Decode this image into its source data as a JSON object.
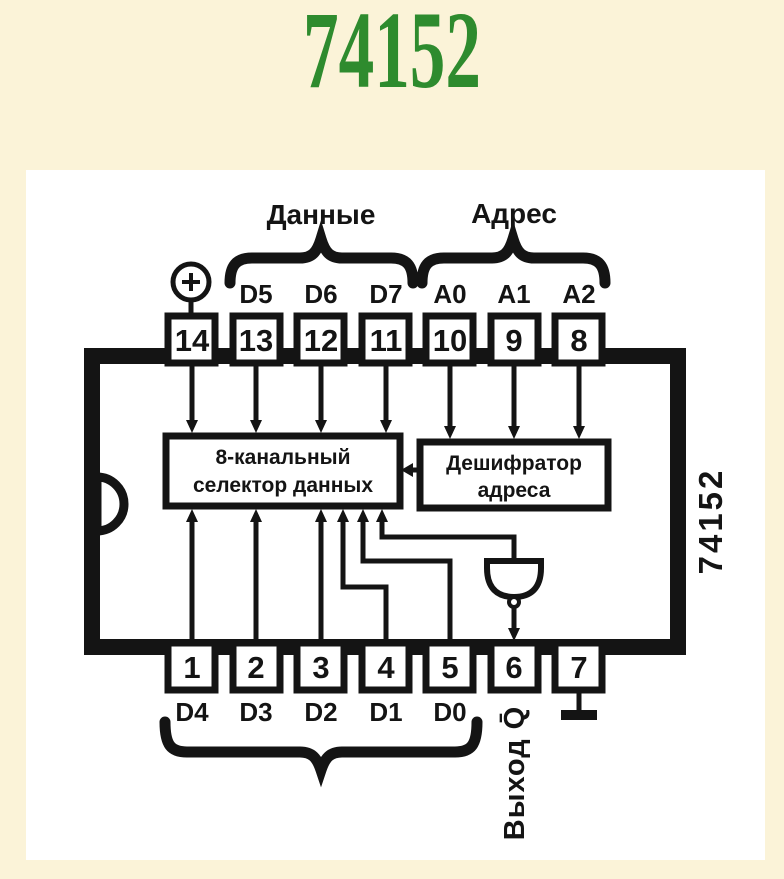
{
  "colors": {
    "background": "#FBF3D8",
    "panel": "#FFFFFF",
    "title_green": "#2E8B2E",
    "ink": "#141414"
  },
  "page": {
    "title": "74152"
  },
  "diagram": {
    "labels": {
      "data_group": "Данные",
      "address_group": "Адрес",
      "inputs_group": "Входы",
      "output": "Выход Q̄",
      "chip_side": "74152"
    },
    "selector_block": {
      "line1": "8-канальный",
      "line2": "селектор данных"
    },
    "decoder_block": {
      "line1": "Дешифратор",
      "line2": "адреса"
    },
    "top_pins": [
      {
        "number": "14",
        "label": ""
      },
      {
        "number": "13",
        "label": "D5"
      },
      {
        "number": "12",
        "label": "D6"
      },
      {
        "number": "11",
        "label": "D7"
      },
      {
        "number": "10",
        "label": "A0"
      },
      {
        "number": "9",
        "label": "A1"
      },
      {
        "number": "8",
        "label": "A2"
      }
    ],
    "bottom_pins": [
      {
        "number": "1",
        "label": "D4"
      },
      {
        "number": "2",
        "label": "D3"
      },
      {
        "number": "3",
        "label": "D2"
      },
      {
        "number": "4",
        "label": "D1"
      },
      {
        "number": "5",
        "label": "D0"
      },
      {
        "number": "6",
        "label": ""
      },
      {
        "number": "7",
        "label": ""
      }
    ]
  }
}
